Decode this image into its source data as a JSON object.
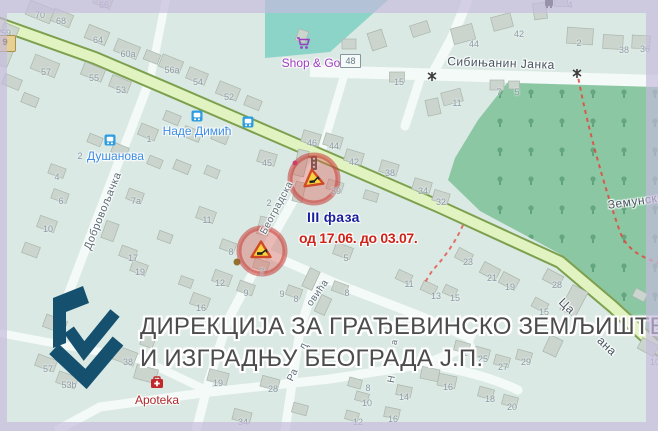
{
  "annotation": {
    "phase": "III фаза",
    "dates": "од 17.06. до 03.07.",
    "phase_color": "#181e9e",
    "date_color": "#d02318"
  },
  "caption": {
    "line1": "ДИРЕКЦИЈА ЗА ГРАЂЕВИНСКО ЗЕМЉИШТЕ",
    "line2": "И ИЗГРАДЊУ БЕОГРАДА Ј.П.",
    "text_color": "#4c4c4c",
    "logo_color": "#15516f"
  },
  "road_chip": "9",
  "boxed_house_number": "48",
  "transit": {
    "label_color": "#3d8de6",
    "stops": [
      {
        "name": "Наде Димић",
        "x": 197,
        "y": 131
      },
      {
        "name": "Душанова",
        "x": 87,
        "y": 156,
        "anchor": "left"
      }
    ]
  },
  "pois": [
    {
      "name": "Shop & Go",
      "x": 311,
      "y": 63,
      "color": "#a03cc4",
      "icon": "shopping-cart-icon"
    },
    {
      "name": "Apoteka",
      "x": 157,
      "y": 400,
      "color": "#b02a2e",
      "icon": "first-aid-kit-icon"
    }
  ],
  "streets": [
    {
      "text": "Сибињанин Јанка",
      "x": 501,
      "y": 63,
      "rot": 2,
      "size": 12,
      "class": "major"
    },
    {
      "text": "Земунски",
      "x": 636,
      "y": 201,
      "rot": -8,
      "size": 12,
      "class": "major"
    },
    {
      "text": "Добровољачка",
      "x": 103,
      "y": 211,
      "rot": -68,
      "size": 11,
      "class": "minor"
    },
    {
      "text": "Београдска",
      "x": 277,
      "y": 208,
      "rot": -62,
      "size": 10,
      "class": "minor"
    },
    {
      "text": "Ца",
      "x": 567,
      "y": 306,
      "rot": 44,
      "size": 12,
      "class": "major"
    },
    {
      "text": "ана",
      "x": 607,
      "y": 346,
      "rot": 44,
      "size": 12,
      "class": "major"
    },
    {
      "text": "овића",
      "x": 318,
      "y": 293,
      "rot": -55,
      "size": 10,
      "class": "minor"
    },
    {
      "text": "Д",
      "x": 305,
      "y": 347,
      "rot": -65,
      "size": 10,
      "class": "minor"
    },
    {
      "text": "Ра",
      "x": 293,
      "y": 375,
      "rot": -65,
      "size": 10,
      "class": "minor"
    },
    {
      "text": "Н",
      "x": 392,
      "y": 379,
      "rot": -80,
      "size": 10,
      "class": "minor"
    },
    {
      "text": "а",
      "x": 394,
      "y": 342,
      "rot": -80,
      "size": 9,
      "class": "minor"
    }
  ],
  "house_numbers": [
    [
      "59",
      6,
      33
    ],
    [
      "70",
      40,
      15
    ],
    [
      "68",
      61,
      21
    ],
    [
      "66",
      104,
      5
    ],
    [
      "64",
      98,
      40
    ],
    [
      "60a",
      128,
      54
    ],
    [
      "57",
      46,
      72
    ],
    [
      "55",
      94,
      78
    ],
    [
      "53",
      121,
      90
    ],
    [
      "56a",
      172,
      70
    ],
    [
      "54",
      198,
      82
    ],
    [
      "52",
      229,
      97
    ],
    [
      "1",
      149,
      139
    ],
    [
      "4",
      57,
      177
    ],
    [
      "6",
      61,
      201
    ],
    [
      "2",
      80,
      156
    ],
    [
      "10",
      48,
      229
    ],
    [
      "11",
      207,
      220
    ],
    [
      "17",
      133,
      258
    ],
    [
      "19",
      140,
      272
    ],
    [
      "7a",
      136,
      201
    ],
    [
      "45",
      267,
      163
    ],
    [
      "46",
      312,
      143
    ],
    [
      "44",
      334,
      146
    ],
    [
      "42",
      354,
      162
    ],
    [
      "38",
      390,
      173
    ],
    [
      "34",
      423,
      191
    ],
    [
      "32",
      441,
      202
    ],
    [
      "39",
      336,
      191
    ],
    [
      "2",
      269,
      203
    ],
    [
      "15",
      399,
      82
    ],
    [
      "44",
      474,
      44
    ],
    [
      "42",
      519,
      34
    ],
    [
      "11",
      457,
      103
    ],
    [
      "7",
      499,
      92
    ],
    [
      "5",
      517,
      92
    ],
    [
      "4",
      570,
      5
    ],
    [
      "2",
      579,
      43
    ],
    [
      "38",
      624,
      50
    ],
    [
      "36",
      645,
      49
    ],
    [
      "5",
      346,
      258
    ],
    [
      "8",
      231,
      252
    ],
    [
      "7",
      262,
      272
    ],
    [
      "12",
      220,
      283
    ],
    [
      "9",
      246,
      293
    ],
    [
      "8",
      296,
      299
    ],
    [
      "8",
      347,
      293
    ],
    [
      "9",
      282,
      294
    ],
    [
      "11",
      409,
      284
    ],
    [
      "13",
      436,
      296
    ],
    [
      "15",
      455,
      298
    ],
    [
      "16",
      201,
      308
    ],
    [
      "23",
      468,
      262
    ],
    [
      "21",
      492,
      278
    ],
    [
      "19",
      510,
      287
    ],
    [
      "28",
      557,
      285
    ],
    [
      "15",
      544,
      312
    ],
    [
      "44",
      58,
      330
    ],
    [
      "57",
      48,
      369
    ],
    [
      "53b",
      69,
      385
    ],
    [
      "38",
      128,
      362
    ],
    [
      "19",
      218,
      383
    ],
    [
      "28",
      273,
      389
    ],
    [
      "34",
      243,
      422
    ],
    [
      "8",
      368,
      388
    ],
    [
      "10",
      367,
      403
    ],
    [
      "12",
      358,
      422
    ],
    [
      "14",
      404,
      397
    ],
    [
      "16",
      448,
      387
    ],
    [
      "16",
      393,
      419
    ],
    [
      "21",
      463,
      353
    ],
    [
      "25",
      483,
      359
    ],
    [
      "27",
      503,
      367
    ],
    [
      "29",
      526,
      362
    ],
    [
      "18",
      490,
      399
    ],
    [
      "20",
      512,
      407
    ],
    [
      "10",
      655,
      362
    ]
  ],
  "markers": [
    {
      "type": "roadworks-sign",
      "x": 314,
      "y": 179
    },
    {
      "type": "roadworks-sign",
      "x": 262,
      "y": 251
    }
  ],
  "icon_names": [
    "bus-stop-icon",
    "railway-crossing-icon",
    "tram-stop-icon",
    "shopping-cart-icon",
    "first-aid-kit-icon",
    "traffic-light-icon",
    "roadworks-sign-icon",
    "tree-icon"
  ],
  "colors": {
    "map_background": "#dbe9e4",
    "park_green": "#8cc7a4",
    "main_road_fill": "#e1f3c1",
    "main_road_casing": "#7da04e",
    "minor_road": "#f4faf7",
    "building_fill": "#cbd5ce",
    "warning_circle": "rgba(198,59,53,0.55)",
    "boundary_dashed": "#e2473c",
    "teal_zone": "#82d2c3"
  }
}
